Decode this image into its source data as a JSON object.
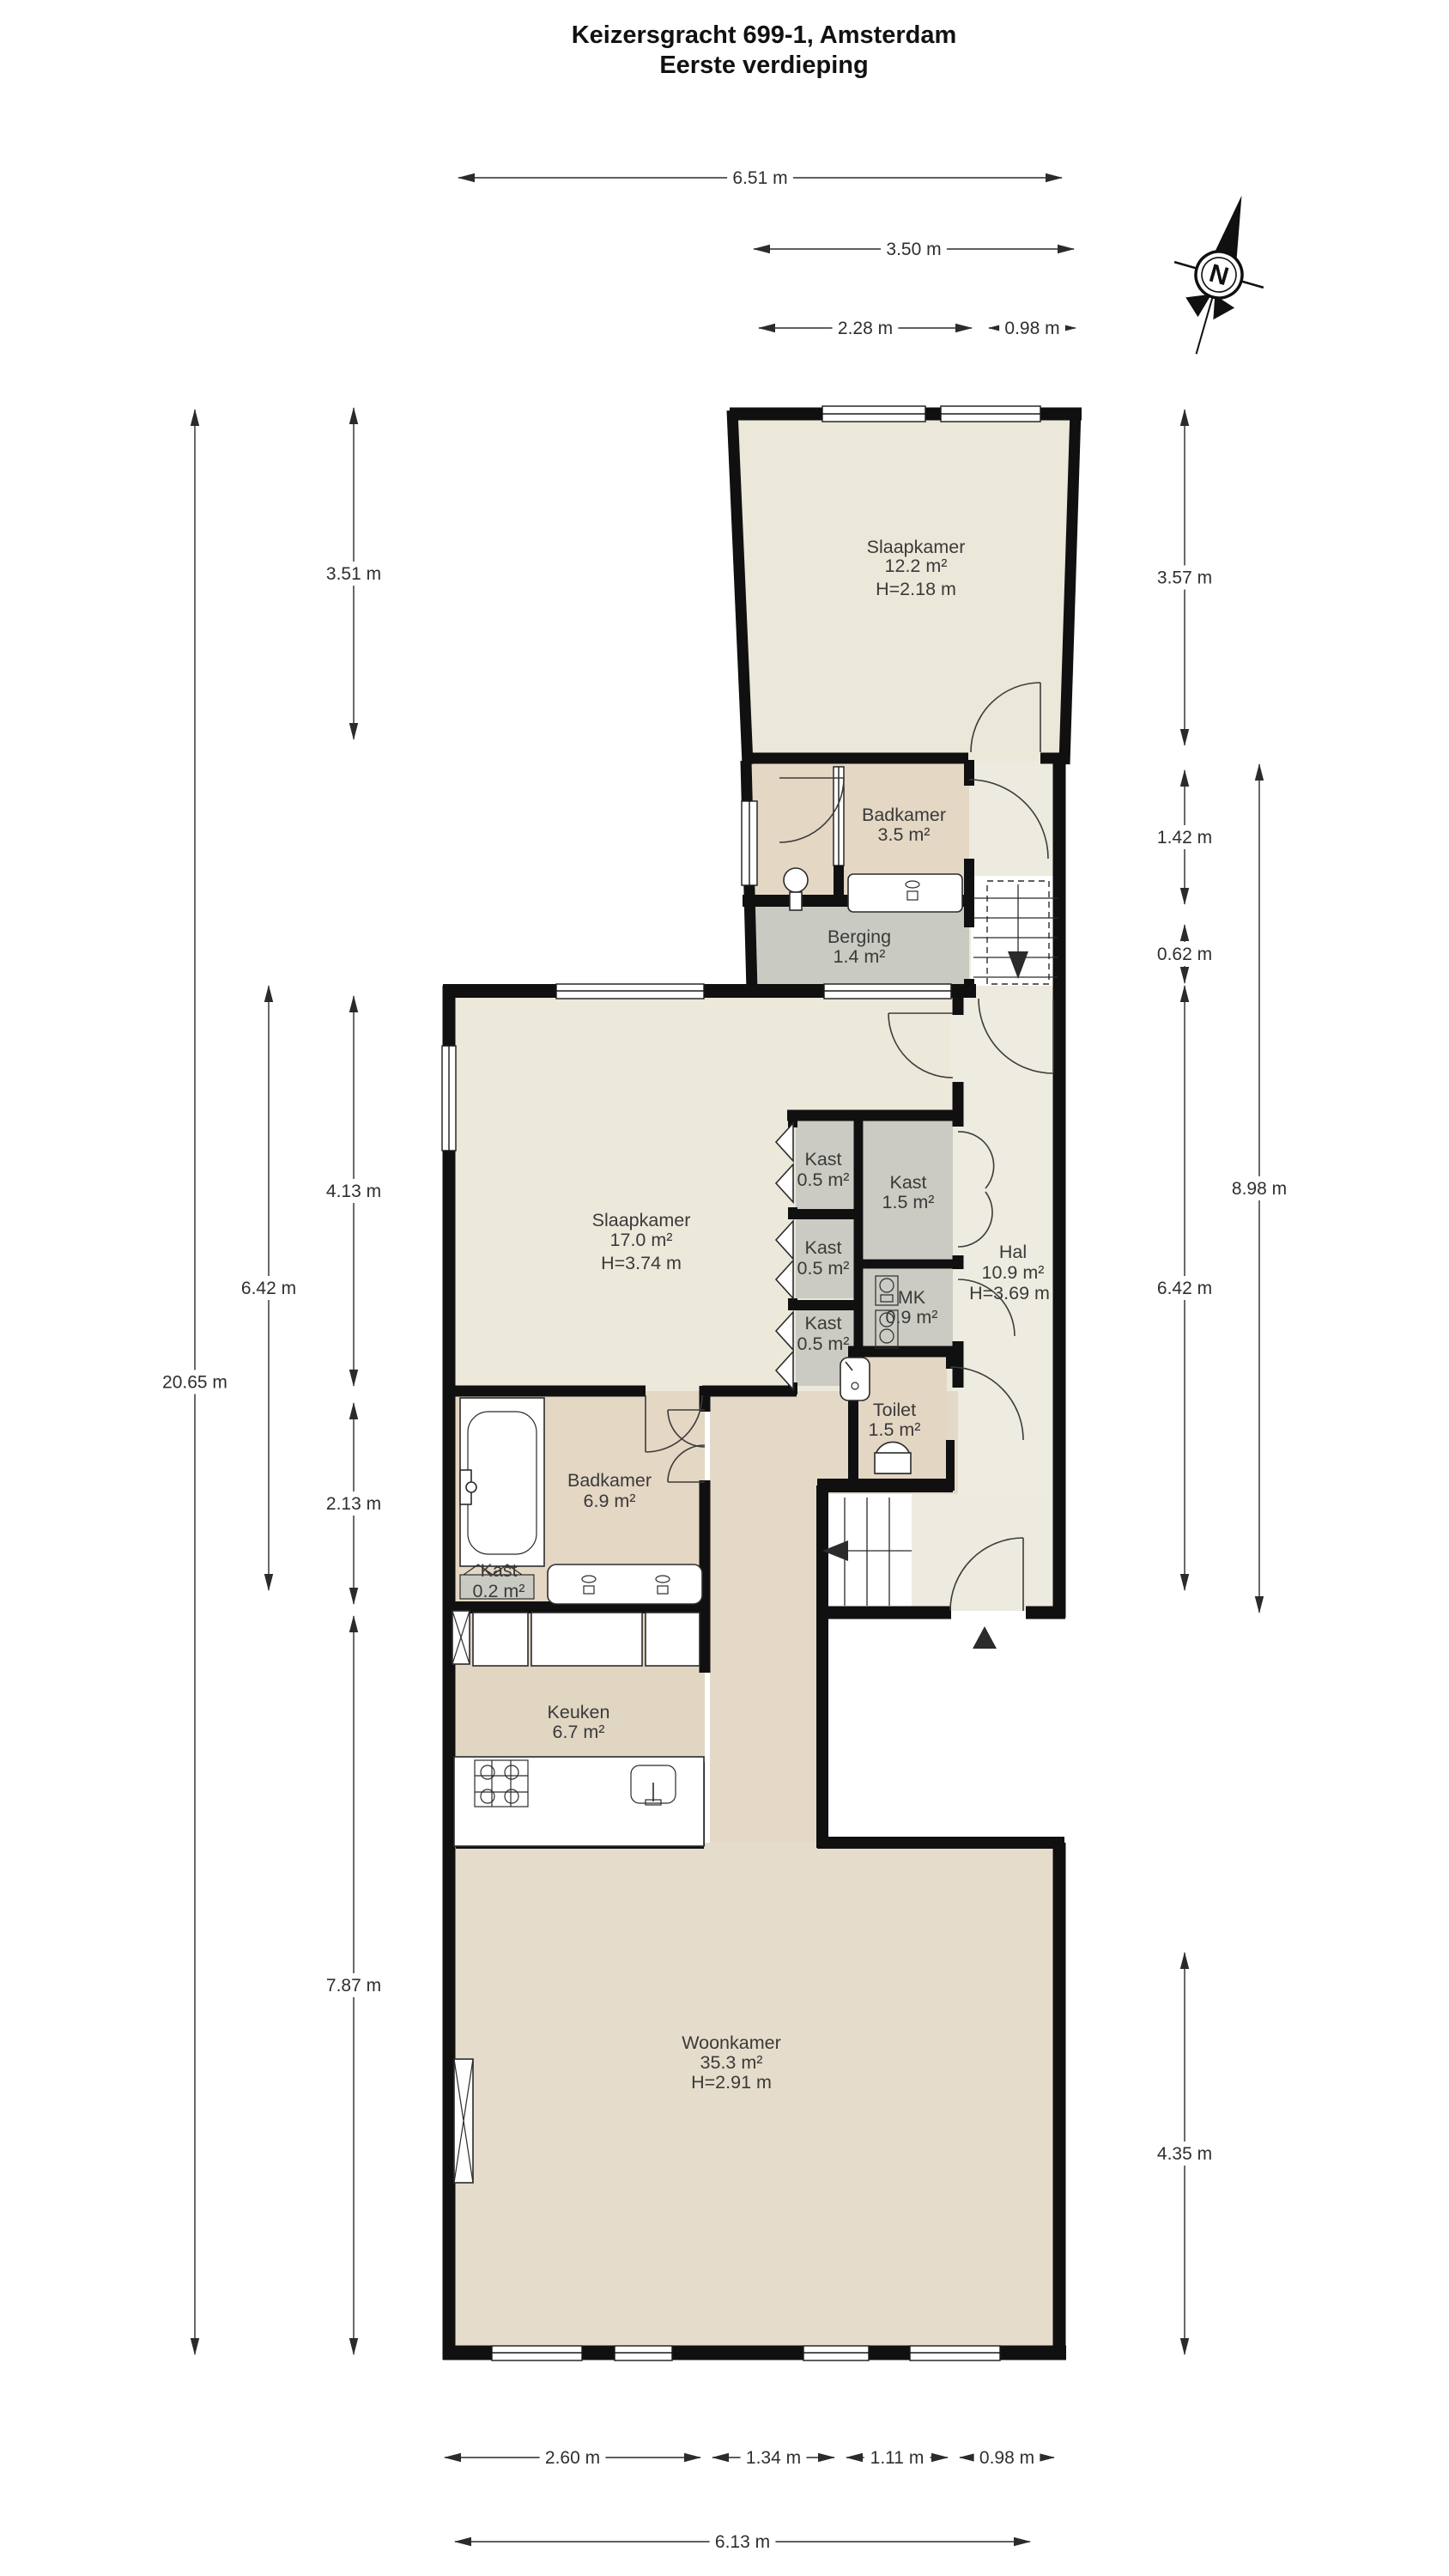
{
  "title": {
    "line1": "Keizersgracht 699-1, Amsterdam",
    "line2": "Eerste verdieping"
  },
  "compass": {
    "label": "N"
  },
  "rooms": {
    "slaapkamer_boven": {
      "name": "Slaapkamer",
      "area": "12.2 m²",
      "height": "H=2.18 m"
    },
    "badkamer_boven": {
      "name": "Badkamer",
      "area": "3.5 m²"
    },
    "berging": {
      "name": "Berging",
      "area": "1.4 m²"
    },
    "slaapkamer": {
      "name": "Slaapkamer",
      "area": "17.0 m²",
      "height": "H=3.74 m"
    },
    "kast_a": {
      "name": "Kast",
      "area": "0.5 m²"
    },
    "kast_b": {
      "name": "Kast",
      "area": "0.5 m²"
    },
    "kast_c": {
      "name": "Kast",
      "area": "0.5 m²"
    },
    "kast_groot": {
      "name": "Kast",
      "area": "1.5 m²"
    },
    "mk": {
      "name": "MK",
      "area": "0.9 m²"
    },
    "hal": {
      "name": "Hal",
      "area": "10.9 m²",
      "height": "H=3.69 m"
    },
    "toilet": {
      "name": "Toilet",
      "area": "1.5 m²"
    },
    "badkamer": {
      "name": "Badkamer",
      "area": "6.9 m²"
    },
    "kast_klein": {
      "name": "Kast",
      "area": "0.2 m²"
    },
    "keuken": {
      "name": "Keuken",
      "area": "6.7 m²"
    },
    "woonkamer": {
      "name": "Woonkamer",
      "area": "35.3 m²",
      "height": "H=2.91 m"
    }
  },
  "dims": {
    "top": [
      "6.51 m",
      "3.50 m",
      "2.28 m",
      "0.98 m"
    ],
    "left": [
      "3.51 m",
      "4.13 m",
      "2.13 m",
      "7.87 m",
      "6.42 m",
      "20.65 m"
    ],
    "right": [
      "3.57 m",
      "1.42 m",
      "0.62 m",
      "6.42 m",
      "4.35 m",
      "8.98 m"
    ],
    "bottom": [
      "2.60 m",
      "1.34 m",
      "1.11 m",
      "0.98 m",
      "6.13 m"
    ]
  },
  "colors": {
    "wall": "#101010",
    "room_ivory": "#ece8db",
    "room_tan": "#e4d7c4",
    "room_gray": "#c9cbc3",
    "woonkamer": "#e6dccb",
    "dimension": "#2f2f2f"
  }
}
